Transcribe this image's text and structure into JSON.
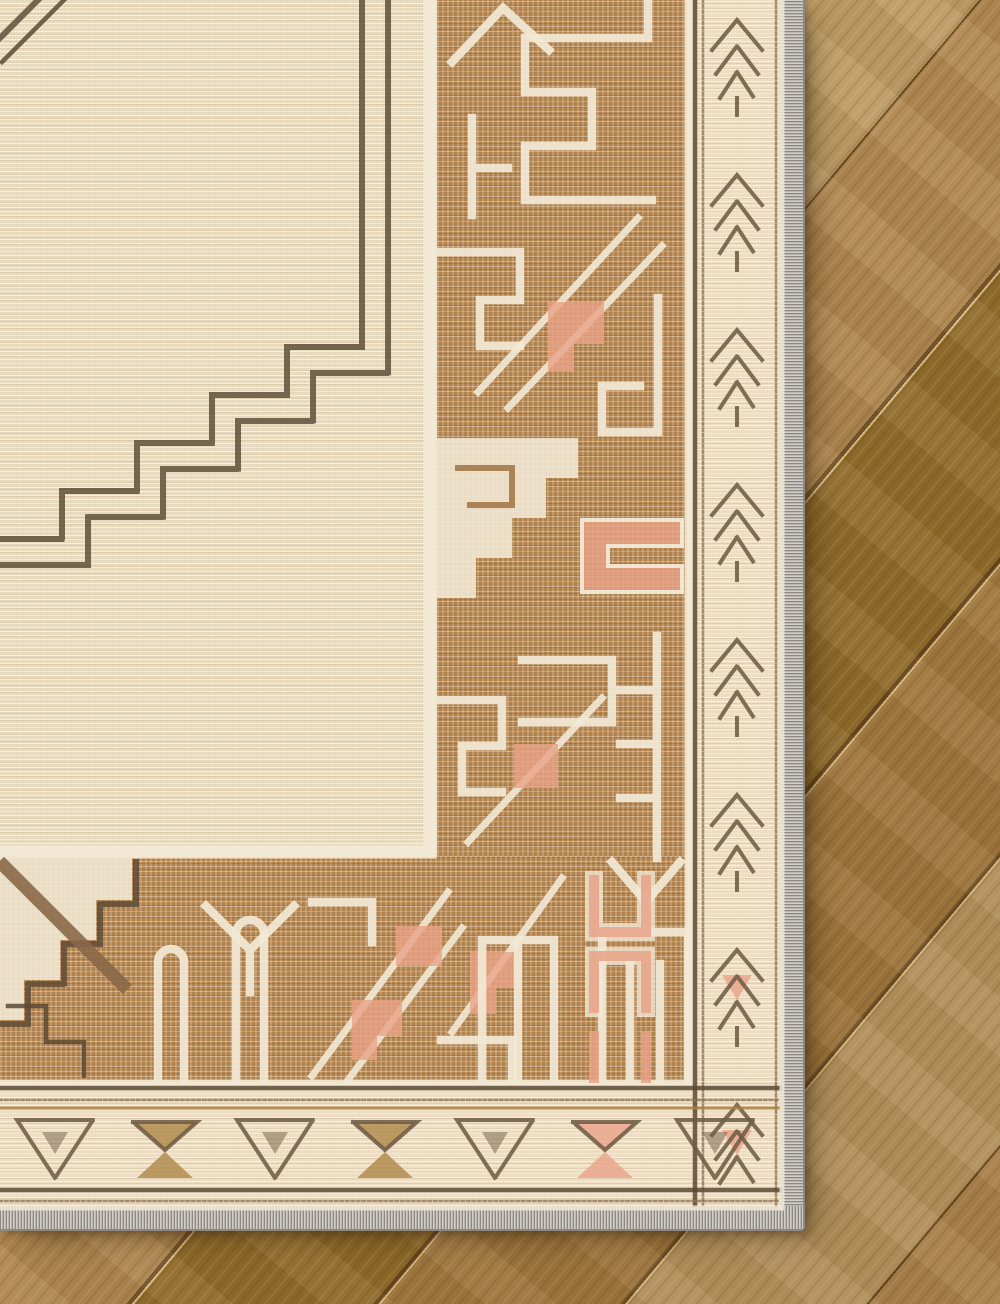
{
  "scene": {
    "description": "Top-down corner detail photograph of a vintage-style cream and tan area rug with a geometric tribal border, lying on diagonal oak hardwood flooring",
    "subject": "area-rug-corner-on-wood-floor",
    "view": "overhead close-up, rug fills top-left, floor visible along right and bottom",
    "elements": [
      "cream rug field with horizontal weave texture",
      "dark brown stitched stepped medallion outline in field",
      "wide tan border band with cream key, hook, ladder and diagonal motifs",
      "salmon stepped-triangle and bracket accents",
      "cream outer guard band with dark pine-tree zigzag motifs (right) and triangle motifs (bottom)",
      "dotted brown guard stripes",
      "light gray serged binding edge",
      "diagonal hardwood planks with grain and seams"
    ]
  },
  "palette": {
    "field": "#e6d8bc",
    "band": "#b2824c",
    "outline-cream": "#f2e9d6",
    "salmon": "#e8a287",
    "stitch-dark": "#5a4935",
    "guard": "#ecdcc2",
    "guard-motif": "#6f5c45",
    "gold": "#a8813f",
    "binding": "#b9b5af",
    "binding-dark": "#8d8780",
    "wood-1": "#b68d55",
    "wood-2": "#97722f",
    "wood-3": "#aa8045",
    "wood-4": "#c2a069",
    "wood-seam": "#6b4b20"
  }
}
